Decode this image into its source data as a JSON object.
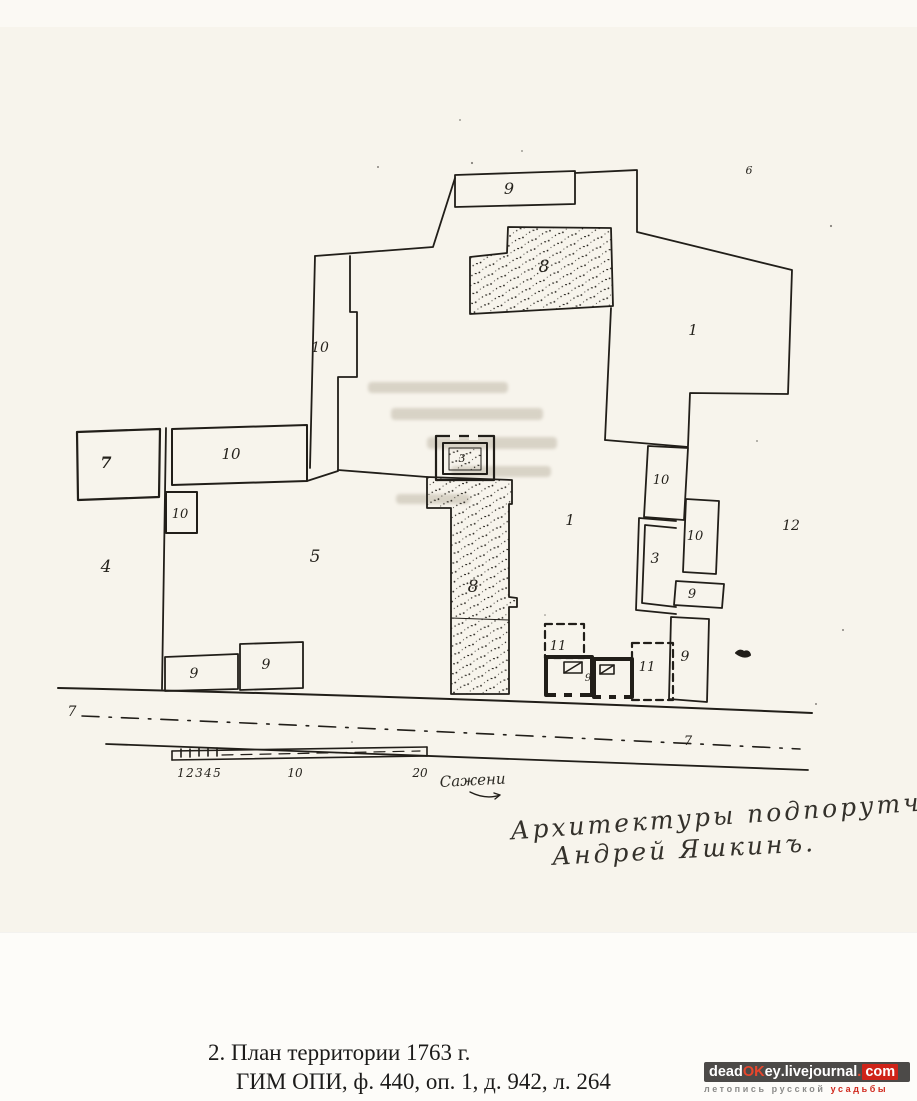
{
  "page": {
    "scan_background": "#f7f4ec",
    "ink_color": "#211e19"
  },
  "plan": {
    "region_labels": [
      {
        "t": "9",
        "x": 509,
        "y": 194,
        "s": 16
      },
      {
        "t": "8",
        "x": 544,
        "y": 272,
        "s": 17
      },
      {
        "t": "6",
        "x": 749,
        "y": 174,
        "s": 11
      },
      {
        "t": "1",
        "x": 693,
        "y": 335,
        "s": 15
      },
      {
        "t": "10",
        "x": 320,
        "y": 352,
        "s": 14
      },
      {
        "t": "10",
        "x": 231,
        "y": 459,
        "s": 15
      },
      {
        "t": "10",
        "x": 180,
        "y": 518,
        "s": 13
      },
      {
        "t": "7",
        "x": 106,
        "y": 468,
        "s": 16,
        "w": "bold"
      },
      {
        "t": "4",
        "x": 106,
        "y": 572,
        "s": 17
      },
      {
        "t": "5",
        "x": 315,
        "y": 562,
        "s": 17
      },
      {
        "t": "3",
        "x": 462,
        "y": 462,
        "s": 11
      },
      {
        "t": "8",
        "x": 473,
        "y": 592,
        "s": 17
      },
      {
        "t": "1",
        "x": 570,
        "y": 525,
        "s": 15
      },
      {
        "t": "10",
        "x": 661,
        "y": 484,
        "s": 13
      },
      {
        "t": "3",
        "x": 655,
        "y": 563,
        "s": 14
      },
      {
        "t": "10",
        "x": 695,
        "y": 540,
        "s": 13
      },
      {
        "t": "9",
        "x": 692,
        "y": 598,
        "s": 13
      },
      {
        "t": "9",
        "x": 685,
        "y": 661,
        "s": 14
      },
      {
        "t": "12",
        "x": 791,
        "y": 530,
        "s": 14
      },
      {
        "t": "11",
        "x": 558,
        "y": 650,
        "s": 13
      },
      {
        "t": "11",
        "x": 647,
        "y": 671,
        "s": 13
      },
      {
        "t": "9",
        "x": 588,
        "y": 681,
        "s": 10
      },
      {
        "t": "9",
        "x": 194,
        "y": 678,
        "s": 14
      },
      {
        "t": "9",
        "x": 266,
        "y": 669,
        "s": 14
      },
      {
        "t": "7",
        "x": 72,
        "y": 716,
        "s": 14
      },
      {
        "t": "7",
        "x": 688,
        "y": 745,
        "s": 13
      }
    ],
    "scale_bar": {
      "ticks": [
        {
          "label": "1",
          "x": 181
        },
        {
          "label": "2",
          "x": 190
        },
        {
          "label": "3",
          "x": 199
        },
        {
          "label": "4",
          "x": 208
        },
        {
          "label": "5",
          "x": 217
        },
        {
          "label": "10",
          "x": 295
        },
        {
          "label": "20",
          "x": 420
        }
      ],
      "unit_label": "Сажени"
    },
    "signature": {
      "line1": "Архитектуры подпорутчикъ",
      "line2": "Андрей Яшкинъ."
    }
  },
  "caption": {
    "line1": "2. План территории 1763 г.",
    "line2": "ГИМ ОПИ, ф. 440, оп. 1, д. 942, л. 264"
  },
  "watermark": {
    "site_dead": "dead",
    "site_ok": "OK",
    "site_ey": "ey",
    "site_mid": ".livejournal",
    "site_dot": ".",
    "site_com": "com",
    "tagline_gray": "летопись русской",
    "tagline_red": "усадьбы",
    "accent_color": "#cf2318",
    "box_color": "#4c4a48"
  }
}
